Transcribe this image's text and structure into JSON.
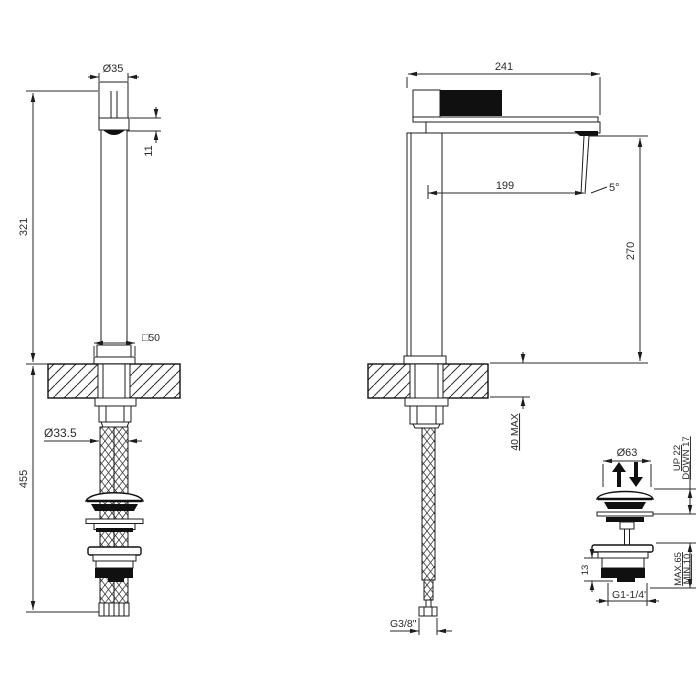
{
  "drawing": {
    "front_view": {
      "top_diameter": "Ø35",
      "spout_tip_height": "11",
      "height_deck_to_top": "321",
      "base_square": "□50",
      "hose_diameter": "Ø33.5",
      "total_height_below": "455"
    },
    "side_view": {
      "spout_total_length": "241",
      "spout_reach": "199",
      "stream_angle": "5°",
      "spout_height_above_deck": "270",
      "deck_thickness": "40 MAX",
      "supply_thread": "G3/8\""
    },
    "waste_detail": {
      "cap_diameter": "Ø63",
      "up_travel": "UP 22",
      "down_travel": "DOWN 17",
      "clamp_max": "MAX.65",
      "clamp_min": "MIN.10",
      "thread_length": "13",
      "waste_thread": "G1-1/4\""
    }
  }
}
